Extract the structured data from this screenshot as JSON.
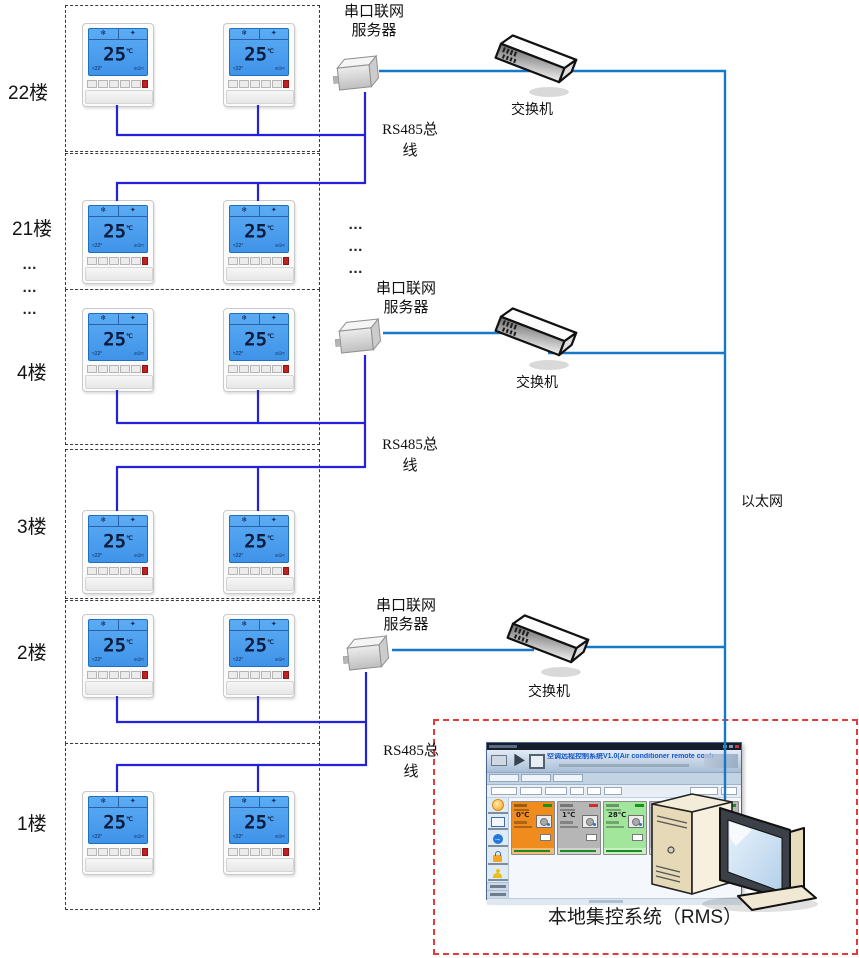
{
  "labels": {
    "floor_22": "22楼",
    "floor_21": "21楼",
    "floor_4": "4楼",
    "floor_3": "3楼",
    "floor_2": "2楼",
    "floor_1": "1楼",
    "ellipsis": "…",
    "server_line1": "串口联网",
    "server_line2": "服务器",
    "switch": "交换机",
    "rs485_line1": "RS485总",
    "rs485_line2": "线",
    "ethernet": "以太网",
    "rms_caption": "本地集控系统（RMS）"
  },
  "thermostat": {
    "temp": "25",
    "unit": "℃",
    "snow_icon": "❄",
    "fan_icon": "✦",
    "status_left": "≈22°",
    "status_right": "≡⊙≈"
  },
  "rms_window": {
    "title": "空调远程控制系统V1.0(Air conditioner remote control system)",
    "cards": [
      {
        "temp": "0℃",
        "bg": "#f08c1e",
        "status_color": "#18941a"
      },
      {
        "temp": "1℃",
        "bg": "#b6b6b6",
        "status_color": "#d42a2a"
      },
      {
        "temp": "28℃",
        "bg": "#a2e69c",
        "status_color": "#18941a"
      },
      {
        "temp": "1℃",
        "bg": "#b6b6b6",
        "status_color": "#18941a"
      },
      {
        "temp": "7℃",
        "bg": "#b6b6b6",
        "status_color": "#18941a"
      }
    ]
  },
  "colors": {
    "rs485_line": "#2222dd",
    "ethernet_line": "#1778c8",
    "red_dashed_box": "#e23b3b"
  }
}
